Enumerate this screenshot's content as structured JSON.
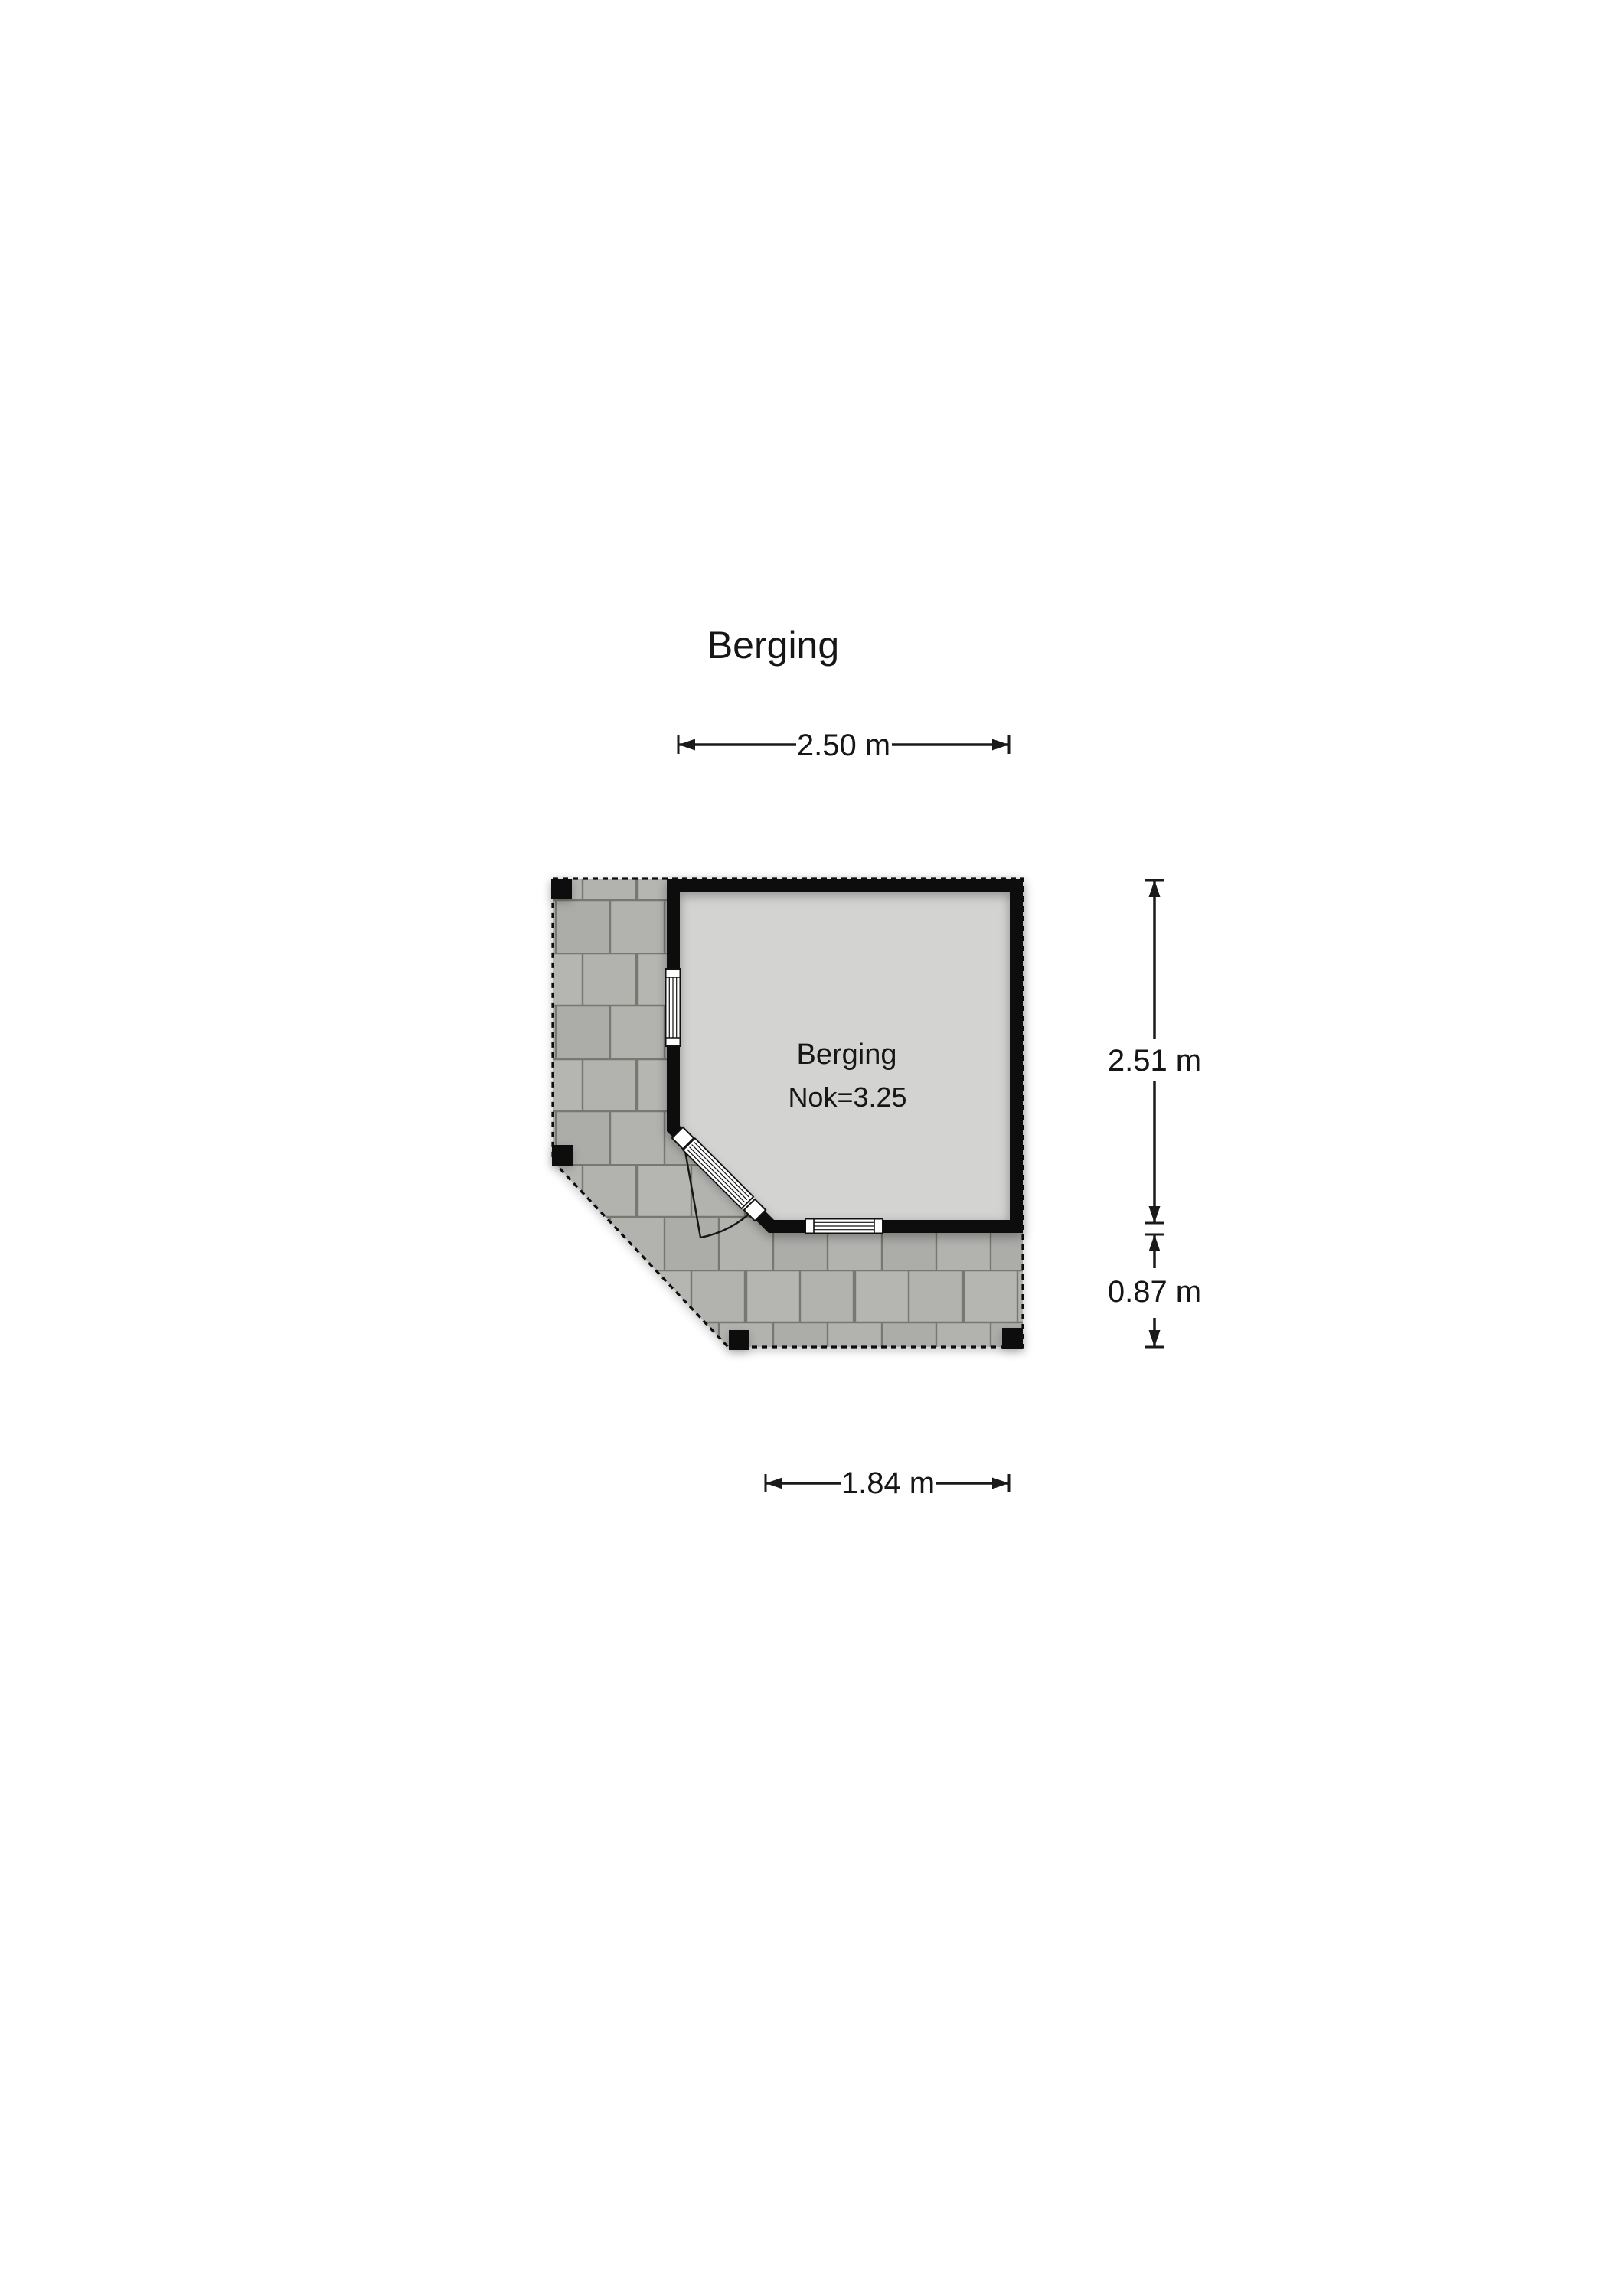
{
  "page": {
    "title": "Berging"
  },
  "floorplan": {
    "room": {
      "name": "Berging",
      "ridge_label": "Nok=3.25"
    },
    "dimensions": {
      "top": "2.50 m",
      "right_upper": "2.51 m",
      "right_lower": "0.87 m",
      "bottom": "1.84 m"
    },
    "colors": {
      "page_bg": "#ffffff",
      "wall": "#0b0b0b",
      "room_floor": "#d3d3d1",
      "patio_tile": "#b2b2af",
      "tile_joint": "#78786f",
      "dim_line": "#1a1a1a"
    },
    "features": {
      "patio": "paved-terrace",
      "posts": 4,
      "windows": 2,
      "doors": 1
    }
  }
}
